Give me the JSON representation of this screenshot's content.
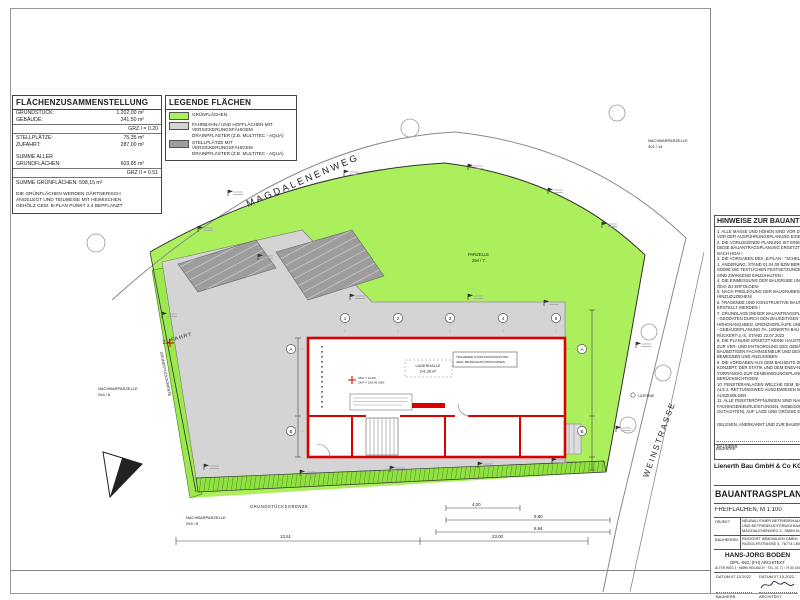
{
  "colors": {
    "green": "#abef5d",
    "green_dark_strip": "#9be84f",
    "paving_light": "#d4d4d4",
    "paving_dark": "#9d9d9d",
    "building_red": "#dd0000"
  },
  "area_table": {
    "title": "FLÄCHENZUSAMMENSTELLUNG",
    "r1l": "GRUNDSTÜCK:",
    "r1v": "1.202,00 m²",
    "r2l": "GEBÄUDE:",
    "r2v": "241,50 m²",
    "grz1": "GRZ I = 0.20",
    "r3l": "STELLPLÄTZE:",
    "r3v": "75,35 m²",
    "r4l": "ZUFAHRT:",
    "r4v": "287,00 m²",
    "r5l": "SUMME ALLER",
    "r6l": "GRUNDFLÄCHEN:",
    "r6v": "603,85 m²",
    "grz2": "GRZ II = 0.51",
    "sum_green": "SUMME GRÜNFLÄCHEN: 598,15 m²",
    "note1": "DIE GRÜNFLÄCHEN WERDEN GÄRTNERISCH",
    "note2": "ANGELEGT UND TEILWEISE MIT HEIMISCHEN",
    "note3": "GEHÖLZ GEM. B-PLAN PUNKT 2.4 BEPFLANZT"
  },
  "legend": {
    "title": "LEGENDE FLÄCHEN",
    "i1": "GRÜNFLÄCHEN",
    "i2a": "FAHRBAHN-/ UND HOFFLÄCHEN MIT",
    "i2b": "VERSICKERUNGSFÄHIGEM",
    "i2c": "DRAINPFLASTER (Z.B. MULTITEC - AQUA)",
    "i3a": "STELLPLÄTZE MIT",
    "i3b": "VERSICKERUNGSFÄHIGEM",
    "i3c": "DRAINPFLASTER (Z.B. MULTITEC - AQUA)"
  },
  "plan": {
    "street_top": "MAGDALENENWEG",
    "street_right": "WEINSTRASSE",
    "zufahrt": "ZUFAHRT",
    "laterne": "LATERNE",
    "parzelle": "PARZELLE",
    "parzelle_no": "294 / 7",
    "nachbar_left": "NACHBARPARZELLE",
    "nachbar_left_no": "294 / 8",
    "nachbar_bottom": "NACHBARPARZELLE",
    "nachbar_bottom_no": "294 / 8",
    "nachbar_topright": "NACHBARPARZELLE",
    "nachbar_topright_no": "301 / 14",
    "grenze_bottom": "GRUNDSTÜCKSGRENZE",
    "grenze_left": "GRUNDSTÜCKSGRENZE",
    "hall": "LAGERHALLE",
    "hall_area": "191,28 m²",
    "note_box_1": "TRAGENDE STAHLKONSTRUKTION",
    "note_box_2": "GEM. BRANDSCHUTZNACHWEIS",
    "okf_1": "OKF = ±0,00",
    "okf_2": "OKF = 192,45 üNN",
    "grid_numbers": [
      "1",
      "2",
      "3",
      "4",
      "5"
    ],
    "grid_letters": [
      "A",
      "B"
    ],
    "dims": {
      "d1": "13,61",
      "d2": "4,00",
      "d3": "9,80",
      "d4": "8,94",
      "d5": "23,00"
    }
  },
  "notes_panel": {
    "title": "HINWEISE ZUR BAUANTRAGSPLANUNG",
    "lines": [
      "1. ALLE MASSE UND HÖHEN SIND VOR DER AUSFÜH",
      "   VOR DER AUSFÜHRUNGSPLANUNG EIGENVERANT",
      "2. DIE VORLIEGENDE PLANUNG IST EINE REINE B",
      "   DIESE BAUANTRAGSPLANUNG ERSETZT KEINE",
      "   NACH HOAI !",
      "3. DIE VORGABEN DES „B-PLAN - \"SCHELMENG",
      "   1. ÄNDERUNG, STAND 01.04.09 BZW BERGZABER",
      "   SOWIE DIE TEXTLICHEN FESTSETZUNGEN ZUM",
      "   SIND ZWINGEND EINZUHALTEN !",
      "4. DIE EINMESSUNG DER BAUGRUBE UND GEBÄU",
      "   ÖbVI ZU ERFOLGEN!",
      "5. NACH FREILEGUNG DER BAUGRUBENSOHLE IS",
      "   HINZUZUZIEHEN!",
      "6. TRAGENDE UND KONSTRUKTIVE BAUTEILE MÜ",
      "   ERSTELLT WERDEN !",
      "7. GRUNDLAGE DIESER BAUANTRAGSPLANUNG:",
      "   - GEODATEN DURCH DEN BAUSEITIGEN VERMES",
      "     HÖHENANGABEN, GRENZVERLÄUFE UND PLAN",
      "   - GEBÄUDEPLANUNG FA. LIENERTH BAU GMBH",
      "     RÜCKERT-2,-S, STAND 22.07.2022",
      "8. DIE PLANUNG ERSETZT KEINE HAUSTECHNIS",
      "   ZUR VER- UND ENTSORGUNG DES GEBÄUDES S",
      "   BAUSEITIGEN FACHINGENIEUR UND DESSEN FA",
      "   BEMESSEN UND ANZUGEBEN",
      "9. DIE VORGABEN AUS DEM BAUSEITS ZU ERSTELL",
      "   KONZEPT, DER STATIK UND DEM ENEV-NACHW",
      "   VORRANGIG ZUR GENEHMIGUNGSPLANUNG ZU",
      "   BERÜCKSICHTIGEN!",
      "10. FENSTERANLAGEN WELCHE GEM. BAUSEITIG",
      "   ALS 2. RETTUNGSWEG AUSGEWIESEN WERDEN",
      "   AUSZUBILDEN",
      "11. ALLE FENSTERÖFFNUNGEN SIND NACH VORL",
      "   FACHINGENIEURLEISTUNGEN, INSBESONDERE",
      "   GUTACHTEN), AUF LAGE UND GRÖSSE EIGENVE"
    ],
    "gelesen": "GELESEN, ANERKANNT UND ZUR BAUEINGABE AN",
    "bauherr_label": "BAUHERR"
  },
  "titleblock": {
    "bauherr_label": "BAUHERR",
    "company": "Lienerth Bau GmbH & Co KG",
    "title": "BAUANTRAGSPLANUNG",
    "subtitle": "FREIFLÄCHEN, M 1:100",
    "objekt_label": "OBJEKT",
    "objekt_l1": "NEUBAU EINER BETRIEBSHALLE",
    "objekt_l2": "UND BETRIEBSLEITERWOHNUNG",
    "objekt_l3": "MAGDALENENWEG 1, 76889 KLIN",
    "bauherrin_label": "BAUHERRIN",
    "bauherrin_l1": "RÜCKERT IMMOBILIEN GMBH, RU",
    "bauherrin_l2": "RUDOLFSTRASSE 4, 76774 LEIME",
    "architect": "HANS-JÖRG BODEN",
    "architect_title": "DIPL.-ING. (FH) ARCHITEKT",
    "architect_address": "ALTER WEG 3 · 66996 HEILBACH · TEL. 01 71 / 79 50 105",
    "datum1": "DATUM  07.10.2022",
    "datum2": "DATUM  07.10.2022",
    "sign_left": "BAUHERR",
    "sign_right": "ARCHITEKT"
  }
}
